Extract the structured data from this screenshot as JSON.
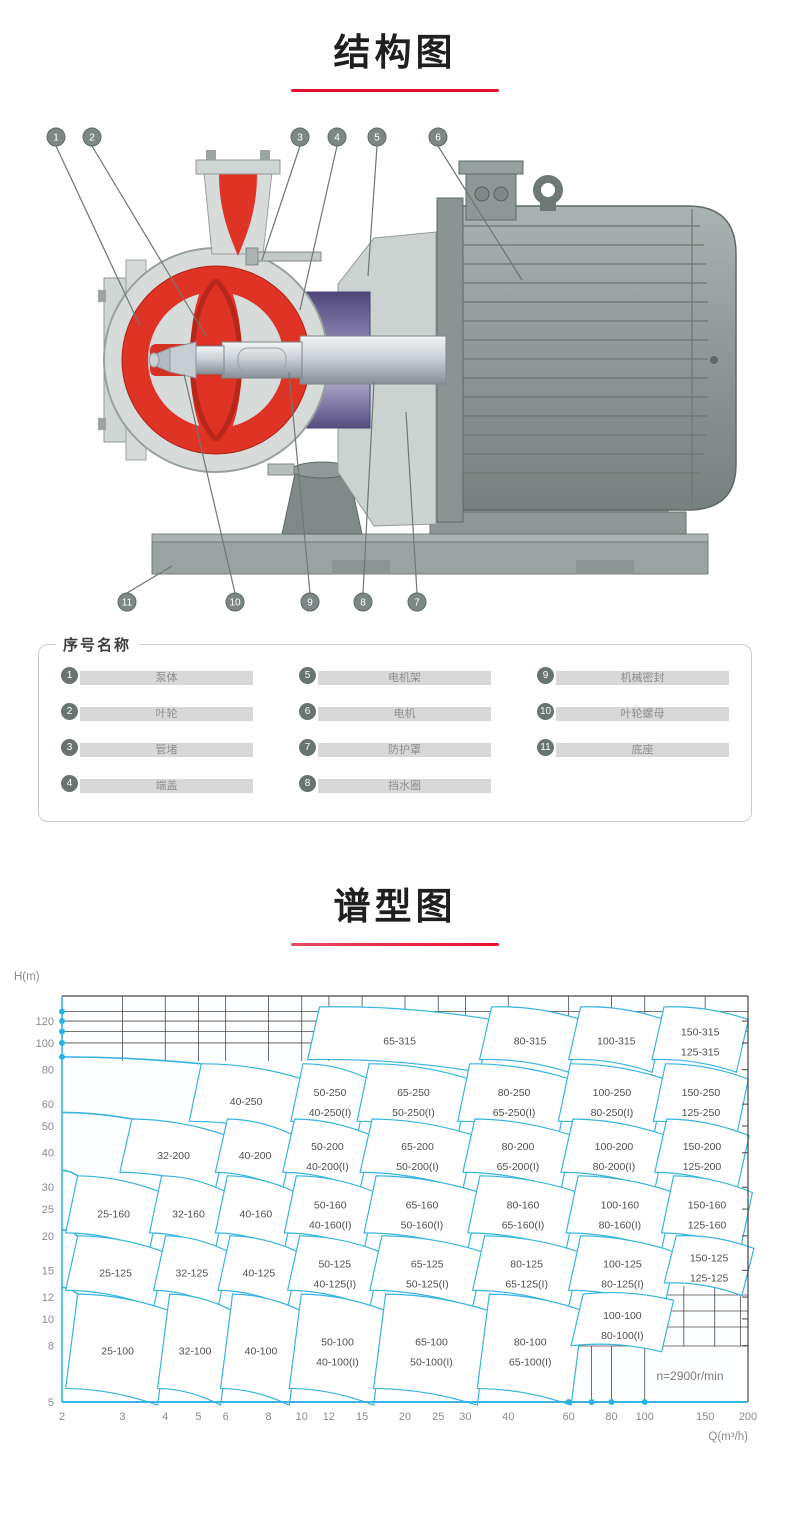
{
  "colors": {
    "accent_red": "#e5102e",
    "chart_line": "#38b4e1",
    "chart_dot": "#27b2e8",
    "grid_black": "#4a4a4a",
    "callout_fill": "#7b8885",
    "pump_red": "#df3425",
    "pump_purple": "#55497c",
    "metal_gray": "#8d9896"
  },
  "sections": {
    "structure_title": "结构图",
    "chart_title": "谱型图"
  },
  "diagram": {
    "callouts_top": [
      "1",
      "2",
      "3",
      "4",
      "5",
      "6"
    ],
    "callouts_bottom": [
      "11",
      "10",
      "9",
      "8",
      "7"
    ]
  },
  "parts": {
    "legend": "序号名称",
    "items": [
      {
        "num": "1",
        "name": "泵体"
      },
      {
        "num": "2",
        "name": "叶轮"
      },
      {
        "num": "3",
        "name": "管堵"
      },
      {
        "num": "4",
        "name": "端盖"
      },
      {
        "num": "5",
        "name": "电机架"
      },
      {
        "num": "6",
        "name": "电机"
      },
      {
        "num": "7",
        "name": "防护罩"
      },
      {
        "num": "8",
        "name": "挡水圈"
      },
      {
        "num": "9",
        "name": "机械密封"
      },
      {
        "num": "10",
        "name": "叶轮螺母"
      },
      {
        "num": "11",
        "name": "底座"
      }
    ]
  },
  "chart_data": {
    "type": "region-map",
    "title": "谱型图",
    "xlabel": "Q(m³/h)",
    "ylabel": "H(m)",
    "x_scale": "log",
    "y_scale": "log",
    "xlim": [
      2,
      200
    ],
    "ylim": [
      5,
      145
    ],
    "x_ticks": [
      2,
      3,
      4,
      5,
      6,
      8,
      10,
      12,
      15,
      20,
      25,
      30,
      40,
      60,
      80,
      100,
      150,
      200
    ],
    "y_ticks": [
      5,
      8,
      10,
      12,
      15,
      20,
      25,
      30,
      40,
      50,
      60,
      80,
      100,
      120
    ],
    "note": "n=2900r/min",
    "axis_dots_h": [
      89,
      100,
      110,
      120,
      130
    ],
    "axis_dots_q": [
      60,
      70,
      80,
      100
    ],
    "regions": [
      {
        "labels": [
          "65-315"
        ],
        "q": [
          10.4,
          33
        ],
        "h": [
          87,
          135
        ],
        "d": 0.9
      },
      {
        "labels": [
          "80-315"
        ],
        "q": [
          33,
          60
        ],
        "h": [
          87,
          135
        ],
        "d": 0.9
      },
      {
        "labels": [
          "100-315"
        ],
        "q": [
          60,
          105
        ],
        "h": [
          87,
          135
        ],
        "d": 0.9
      },
      {
        "labels": [
          "150-315",
          "125-315"
        ],
        "q": [
          105,
          185
        ],
        "h": [
          87,
          135
        ],
        "d": 0.9
      },
      {
        "labels": [
          "40-250"
        ],
        "q": [
          4.7,
          9.3
        ],
        "h": [
          52,
          84
        ],
        "d": 0.88
      },
      {
        "labels": [
          "50-250",
          "40-250(I)"
        ],
        "q": [
          9.3,
          14.5
        ],
        "h": [
          52,
          84
        ],
        "d": 0.88
      },
      {
        "labels": [
          "65-250",
          "50-250(I)"
        ],
        "q": [
          14.5,
          28.5
        ],
        "h": [
          52,
          84
        ],
        "d": 0.88
      },
      {
        "labels": [
          "80-250",
          "65-250(I)"
        ],
        "q": [
          28.5,
          56
        ],
        "h": [
          52,
          84
        ],
        "d": 0.88
      },
      {
        "labels": [
          "100-250",
          "80-250(I)"
        ],
        "q": [
          56,
          106
        ],
        "h": [
          52,
          84
        ],
        "d": 0.88
      },
      {
        "labels": [
          "150-250",
          "125-250"
        ],
        "q": [
          106,
          185
        ],
        "h": [
          52,
          84
        ],
        "d": 0.88
      },
      {
        "labels": [
          "32-200"
        ],
        "q": [
          2.95,
          5.6
        ],
        "h": [
          34,
          53
        ]
      },
      {
        "labels": [
          "40-200"
        ],
        "q": [
          5.6,
          8.8
        ],
        "h": [
          34,
          53
        ]
      },
      {
        "labels": [
          "50-200",
          "40-200(I)"
        ],
        "q": [
          8.8,
          14.8
        ],
        "h": [
          34,
          53
        ]
      },
      {
        "labels": [
          "65-200",
          "50-200(I)"
        ],
        "q": [
          14.8,
          29.5
        ],
        "h": [
          34,
          53
        ]
      },
      {
        "labels": [
          "80-200",
          "65-200(I)"
        ],
        "q": [
          29.5,
          57
        ],
        "h": [
          34,
          53
        ]
      },
      {
        "labels": [
          "100-200",
          "80-200(I)"
        ],
        "q": [
          57,
          107
        ],
        "h": [
          34,
          53
        ]
      },
      {
        "labels": [
          "150-200",
          "125-200"
        ],
        "q": [
          107,
          186
        ],
        "h": [
          34,
          53
        ]
      },
      {
        "labels": [
          "25-160"
        ],
        "q": [
          2.05,
          3.6
        ],
        "h": [
          20.5,
          33
        ]
      },
      {
        "labels": [
          "32-160"
        ],
        "q": [
          3.6,
          5.6
        ],
        "h": [
          20.5,
          33
        ]
      },
      {
        "labels": [
          "40-160"
        ],
        "q": [
          5.6,
          8.9
        ],
        "h": [
          20.5,
          33
        ]
      },
      {
        "labels": [
          "50-160",
          "40-160(I)"
        ],
        "q": [
          8.9,
          15.2
        ],
        "h": [
          20.5,
          33
        ]
      },
      {
        "labels": [
          "65-160",
          "50-160(I)"
        ],
        "q": [
          15.2,
          30.5
        ],
        "h": [
          20.5,
          33
        ]
      },
      {
        "labels": [
          "80-160",
          "65-160(I)"
        ],
        "q": [
          30.5,
          59
        ],
        "h": [
          20.5,
          33
        ]
      },
      {
        "labels": [
          "100-160",
          "80-160(I)"
        ],
        "q": [
          59,
          112
        ],
        "h": [
          20.5,
          33
        ]
      },
      {
        "labels": [
          "150-160",
          "125-160"
        ],
        "q": [
          112,
          190
        ],
        "h": [
          20.5,
          33
        ]
      },
      {
        "labels": [
          "25-125"
        ],
        "q": [
          2.05,
          3.7
        ],
        "h": [
          12.7,
          20
        ]
      },
      {
        "labels": [
          "32-125"
        ],
        "q": [
          3.7,
          5.7
        ],
        "h": [
          12.7,
          20
        ]
      },
      {
        "labels": [
          "40-125"
        ],
        "q": [
          5.7,
          9.1
        ],
        "h": [
          12.7,
          20
        ]
      },
      {
        "labels": [
          "50-125",
          "40-125(I)"
        ],
        "q": [
          9.1,
          15.8
        ],
        "h": [
          12.7,
          20
        ]
      },
      {
        "labels": [
          "65-125",
          "50-125(I)"
        ],
        "q": [
          15.8,
          31.5
        ],
        "h": [
          12.7,
          20
        ]
      },
      {
        "labels": [
          "80-125",
          "65-125(I)"
        ],
        "q": [
          31.5,
          60
        ],
        "h": [
          12.7,
          20
        ]
      },
      {
        "labels": [
          "100-125",
          "80-125(I)"
        ],
        "q": [
          60,
          114
        ],
        "h": [
          12.7,
          20
        ]
      },
      {
        "labels": [
          "150-125",
          "125-125"
        ],
        "q": [
          114,
          192
        ],
        "h": [
          13.5,
          20
        ],
        "d": 0.9
      },
      {
        "labels": [
          "25-100"
        ],
        "q": [
          2.05,
          3.8
        ],
        "h": [
          5.6,
          12.3
        ]
      },
      {
        "labels": [
          "32-100"
        ],
        "q": [
          3.8,
          5.8
        ],
        "h": [
          5.6,
          12.3
        ]
      },
      {
        "labels": [
          "40-100"
        ],
        "q": [
          5.8,
          9.2
        ],
        "h": [
          5.6,
          12.3
        ]
      },
      {
        "labels": [
          "50-100",
          "40-100(I)"
        ],
        "q": [
          9.2,
          16.2
        ],
        "h": [
          5.6,
          12.3
        ]
      },
      {
        "labels": [
          "65-100",
          "50-100(I)"
        ],
        "q": [
          16.2,
          32.5
        ],
        "h": [
          5.6,
          12.3
        ]
      },
      {
        "labels": [
          "80-100",
          "65-100(I)"
        ],
        "q": [
          32.5,
          61
        ],
        "h": [
          5.6,
          12.3
        ]
      },
      {
        "labels": [
          "100-100",
          "80-100(I)"
        ],
        "q": [
          61,
          112
        ],
        "h": [
          8.0,
          12.3
        ],
        "d": 0.95
      }
    ]
  }
}
